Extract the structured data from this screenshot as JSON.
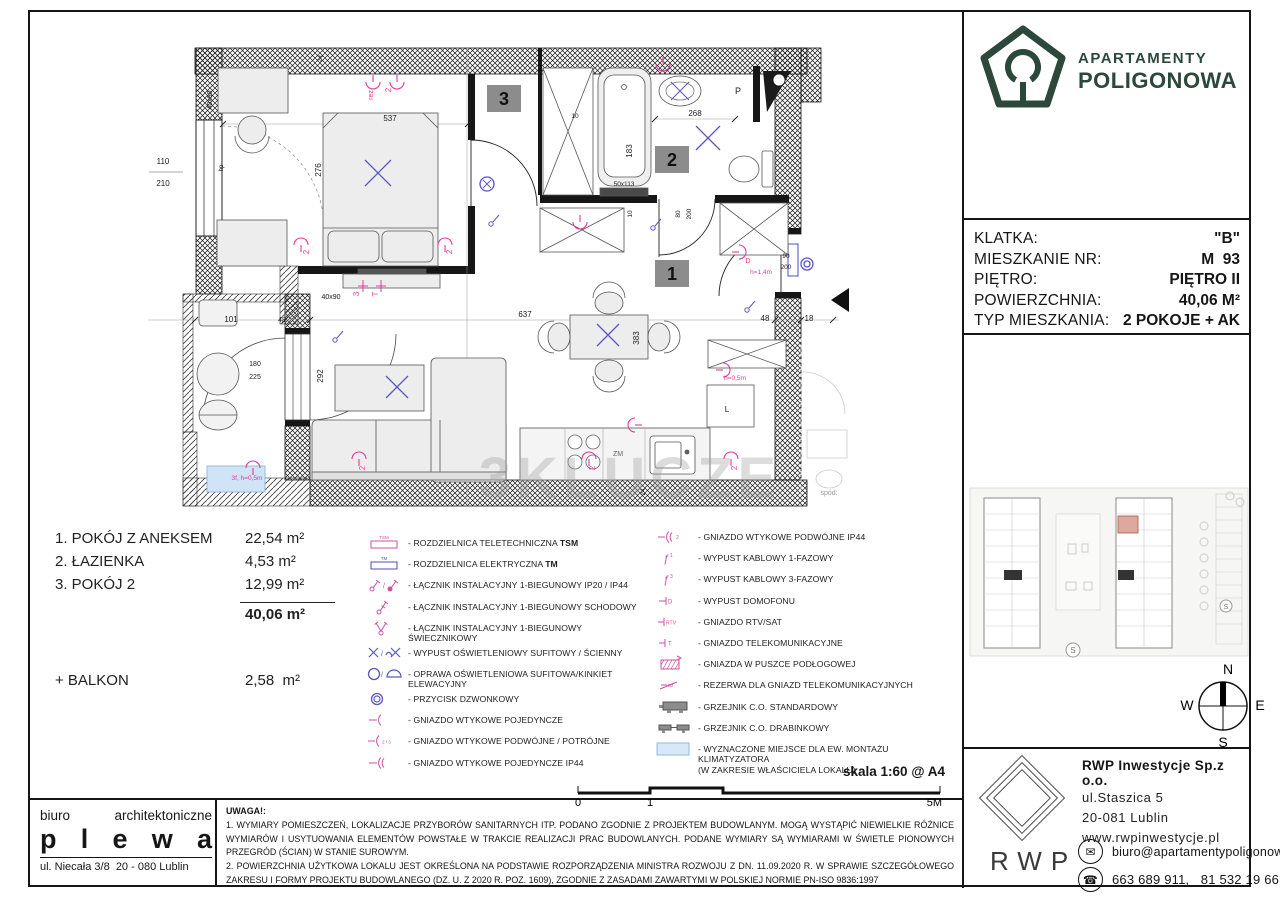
{
  "logo": {
    "line1": "APARTAMENTY",
    "line2": "POLIGONOWA",
    "brand_color": "#2c473c"
  },
  "info_panel": {
    "rows": [
      {
        "label": "KLATKA:",
        "value": "\"B\""
      },
      {
        "label": "MIESZKANIE NR:",
        "value": "M  93"
      },
      {
        "label": "PIĘTRO:",
        "value": "PIĘTRO II"
      },
      {
        "label": "POWIERZCHNIA:",
        "value": "40,06 M²"
      },
      {
        "label": "TYP MIESZKANIA:",
        "value": "2 POKOJE + AK"
      }
    ]
  },
  "room_list": {
    "items": [
      {
        "name": "1. POKÓJ Z ANEKSEM",
        "area": "22,54 m²"
      },
      {
        "name": "2. ŁAZIENKA",
        "area": "4,53 m²"
      },
      {
        "name": "3. POKÓJ 2",
        "area": "12,99 m²"
      }
    ],
    "total": "40,06 m²",
    "balcony_label": "+ BALKON",
    "balcony_area": "2,58  m²"
  },
  "legend": {
    "left": [
      {
        "symbol": "tsm-box",
        "sym_text": "TSM",
        "label": "- ROZDZIELNICA TELETECHNICZNA ",
        "bold": "TSM"
      },
      {
        "symbol": "tm-box",
        "sym_text": "TM",
        "label": "- ROZDZIELNICA ELEKTRYCZNA ",
        "bold": "TM"
      },
      {
        "symbol": "switch-1",
        "label": "- ŁĄCZNIK INSTALACYJNY 1-BIEGUNOWY IP20 / IP44"
      },
      {
        "symbol": "switch-schodowy",
        "label": "- ŁĄCZNIK INSTALACYJNY 1-BIEGUNOWY SCHODOWY"
      },
      {
        "symbol": "switch-swiecznikowy",
        "label": "- ŁĄCZNIK INSTALACYJNY 1-BIEGUNOWY ŚWIECZNIKOWY"
      },
      {
        "symbol": "wypust-osw",
        "label": "- WYPUST OŚWIETLENIOWY SUFITOWY / ŚCIENNY"
      },
      {
        "symbol": "oprawa",
        "label": "- OPRAWA OŚWIETLENIOWA SUFITOWA/KINKIET ELEWACYJNY"
      },
      {
        "symbol": "przycisk",
        "label": "- PRZYCISK DZWONKOWY"
      },
      {
        "symbol": "gniazdo-1",
        "label": "- GNIAZDO WTYKOWE POJEDYNCZE"
      },
      {
        "symbol": "gniazdo-23",
        "label": "- GNIAZDO WTYKOWE PODWÓJNE / POTRÓJNE"
      },
      {
        "symbol": "gniazdo-1-ip44",
        "label": "- GNIAZDO WTYKOWE POJEDYNCZE IP44"
      }
    ],
    "right": [
      {
        "symbol": "gniazdo-2-ip44",
        "label": "- GNIAZDO WTYKOWE PODWÓJNE IP44"
      },
      {
        "symbol": "wypust-1f",
        "label": "- WYPUST KABLOWY 1-FAZOWY"
      },
      {
        "symbol": "wypust-3f",
        "label": "- WYPUST KABLOWY 3-FAZOWY"
      },
      {
        "symbol": "domofon",
        "label": "- WYPUST DOMOFONU"
      },
      {
        "symbol": "rtv",
        "label": "- GNIAZDO RTV/SAT"
      },
      {
        "symbol": "telekom",
        "label": "- GNIAZDO TELEKOMUNIKACYJNE"
      },
      {
        "symbol": "puszka",
        "label": "- GNIAZDA W PUSZCE PODŁOGOWEJ"
      },
      {
        "symbol": "rezerwa",
        "label": "- REZERWA DLA GNIAZD TELEKOMUNIKACYJNYCH"
      },
      {
        "symbol": "grzejnik-std",
        "label": "- GRZEJNIK C.O. STANDARDOWY"
      },
      {
        "symbol": "grzejnik-drab",
        "label": "- GRZEJNIK C.O. DRABINKOWY"
      },
      {
        "symbol": "klimatyzator",
        "label": "- WYZNACZONE MIEJSCE DLA EW. MONTAŻU KLIMATYZATORA",
        "label2": "(W ZAKRESIE WŁAŚCICIELA LOKALU)"
      }
    ]
  },
  "scale": {
    "label": "skala 1:60 @ A4",
    "ticks": [
      "0",
      "1",
      "5M"
    ]
  },
  "notes": {
    "title": "UWAGA!:",
    "items": [
      "1. WYMIARY POMIESZCZEŃ, LOKALIZACJE PRZYBORÓW SANITARNYCH ITP. PODANO ZGODNIE Z PROJEKTEM BUDOWLANYM. MOGĄ WYSTĄPIĆ NIEWIELKIE RÓŻNICE WYMIARÓW I USYTUOWANIA ELEMENTÓW POWSTAŁE W TRAKCIE REALIZACJI PRAC BUDOWLANYCH. PODANE WYMIARY SĄ WYMIARAMI W ŚWIETLE PIONOWYCH PRZEGRÓD (ŚCIAN) W STANIE SUROWYM.",
      "2. POWIERZCHNIA UŻYTKOWA LOKALU JEST OKREŚLONA NA PODSTAWIE ROZPORZĄDZENIA MINISTRA ROZWOJU Z DN. 11.09.2020 R. W SPRAWIE SZCZEGÓŁOWEGO ZAKRESU I FORMY PROJEKTU BUDOWLANEGO (DZ. U. Z 2020 R. POZ. 1609), ZGODNIE Z ZASADAMI ZAWARTYMI W POLSKIEJ NORMIE PN-ISO 9836:1997"
    ]
  },
  "architect": {
    "line1a": "biuro",
    "line1b": "architektoniczne",
    "name_letters": [
      "p",
      "l",
      "e",
      "w",
      "a"
    ],
    "address": "ul. Niecała 3/8  20 - 080 Lublin"
  },
  "developer": {
    "name": "RWP Inwestycje Sp.z o.o.",
    "street": "ul.Staszica 5",
    "city": "20-081 Lublin",
    "website": "www.rwpinwestycje.pl",
    "email": "biuro@apartamentypoligonowa.pl",
    "phones": "663 689 911,   81 532 19 66",
    "logo_text": "RWP"
  },
  "compass": {
    "n": "N",
    "e": "E",
    "s": "S",
    "w": "W"
  },
  "site": {
    "s1": "S",
    "s2": "S"
  },
  "plan": {
    "watermark": "3KLUCZE",
    "labels": [
      {
        "t": "3",
        "x": 352,
        "y": 47,
        "k": "box"
      },
      {
        "t": "2",
        "x": 520,
        "y": 108,
        "k": "box"
      },
      {
        "t": "1",
        "x": 520,
        "y": 222,
        "k": "box"
      },
      {
        "t": "537",
        "x": 255,
        "y": 83
      },
      {
        "t": "276",
        "x": 186,
        "y": 132,
        "r": -90
      },
      {
        "t": "268",
        "x": 560,
        "y": 78
      },
      {
        "t": "183",
        "x": 497,
        "y": 113,
        "r": -90
      },
      {
        "t": "50x113",
        "x": 489,
        "y": 148,
        "s": 6.5
      },
      {
        "t": "10",
        "x": 440,
        "y": 80,
        "s": 6.5
      },
      {
        "t": "10",
        "x": 497,
        "y": 176,
        "r": -90,
        "s": 6.5
      },
      {
        "t": "80",
        "x": 545,
        "y": 176,
        "r": -90,
        "s": 6.5
      },
      {
        "t": "200",
        "x": 556,
        "y": 176,
        "r": -90,
        "s": 6.5
      },
      {
        "t": "110",
        "x": 28,
        "y": 126
      },
      {
        "t": "210",
        "x": 28,
        "y": 148
      },
      {
        "t": "hp",
        "x": 88,
        "y": 130,
        "r": -90,
        "s": 6
      },
      {
        "t": "40x90",
        "x": 77,
        "y": 62,
        "r": -90,
        "s": 7
      },
      {
        "t": "40x90",
        "x": 196,
        "y": 261,
        "s": 7
      },
      {
        "t": "101",
        "x": 96,
        "y": 284
      },
      {
        "t": "180",
        "x": 120,
        "y": 328,
        "s": 7
      },
      {
        "t": "225",
        "x": 120,
        "y": 341,
        "s": 7
      },
      {
        "t": "48",
        "x": 147,
        "y": 284,
        "s": 7
      },
      {
        "t": "292",
        "x": 188,
        "y": 338,
        "r": -90
      },
      {
        "t": "637",
        "x": 390,
        "y": 279
      },
      {
        "t": "383",
        "x": 504,
        "y": 300,
        "r": -90
      },
      {
        "t": "48",
        "x": 630,
        "y": 283
      },
      {
        "t": "18",
        "x": 674,
        "y": 283
      },
      {
        "t": "90",
        "x": 651,
        "y": 220,
        "s": 6.5
      },
      {
        "t": "200",
        "x": 651,
        "y": 231,
        "s": 6.5
      },
      {
        "t": "24",
        "x": 187,
        "y": 21,
        "r": -75,
        "s": 6
      },
      {
        "t": "24",
        "x": 510,
        "y": 454,
        "r": -90,
        "s": 6
      },
      {
        "t": "spód:",
        "x": 694,
        "y": 457,
        "s": 7,
        "c": "#9a9a9a"
      },
      {
        "t": "P",
        "x": 603,
        "y": 56,
        "s": 9
      },
      {
        "t": "L",
        "x": 592,
        "y": 374,
        "s": 8
      },
      {
        "t": "ZM",
        "x": 483,
        "y": 418,
        "s": 7,
        "c": "#666666"
      },
      {
        "t": "rez.",
        "x": 238,
        "y": 56,
        "r": -90,
        "c": "pink",
        "s": 7
      },
      {
        "t": "2",
        "x": 256,
        "y": 52,
        "r": -90,
        "c": "pink"
      },
      {
        "t": "2",
        "x": 174,
        "y": 214,
        "r": -90,
        "c": "pink"
      },
      {
        "t": "2",
        "x": 317,
        "y": 214,
        "r": -90,
        "c": "pink"
      },
      {
        "t": "3",
        "x": 224,
        "y": 256,
        "r": -90,
        "c": "pink"
      },
      {
        "t": "T",
        "x": 243,
        "y": 256,
        "r": -90,
        "c": "pink"
      },
      {
        "t": "2",
        "x": 230,
        "y": 430,
        "r": -90,
        "c": "pink"
      },
      {
        "t": "2",
        "x": 460,
        "y": 430,
        "r": -90,
        "c": "pink"
      },
      {
        "t": "2",
        "x": 602,
        "y": 430,
        "r": -90,
        "c": "pink"
      },
      {
        "t": "h=0,5m",
        "x": 600,
        "y": 342,
        "c": "pink",
        "s": 6.5
      },
      {
        "t": "h=1,4m",
        "x": 626,
        "y": 236,
        "c": "pink",
        "s": 6.5
      },
      {
        "t": "3f, h=0,5m",
        "x": 112,
        "y": 442,
        "c": "pink",
        "s": 6.5
      },
      {
        "t": "D",
        "x": 613,
        "y": 225,
        "c": "pink",
        "s": 7
      },
      {
        "t": "3KLUCZE",
        "x": 495,
        "y": 460,
        "k": "wm"
      }
    ]
  }
}
